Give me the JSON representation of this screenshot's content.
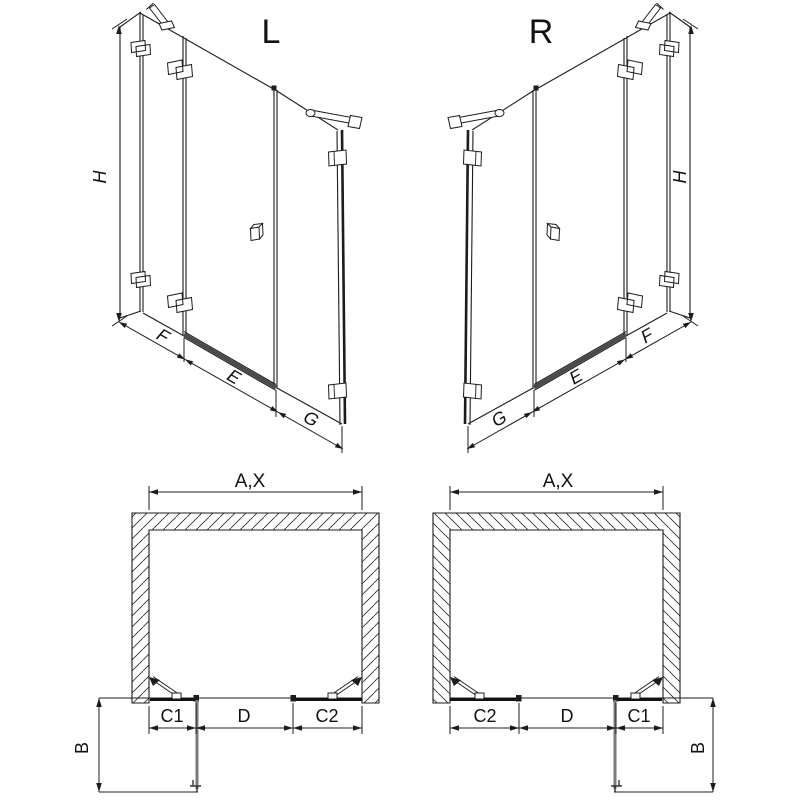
{
  "views": {
    "iso_left": {
      "label": "L",
      "height_dim": "H",
      "bottom_dims": [
        "F",
        "E",
        "G"
      ]
    },
    "iso_right": {
      "label": "R",
      "height_dim": "H",
      "bottom_dims": [
        "G",
        "E",
        "F"
      ]
    },
    "plan_left": {
      "width_dim": "A,X",
      "front_dims": [
        "C1",
        "D",
        "C2"
      ],
      "depth_dim": "B"
    },
    "plan_right": {
      "width_dim": "A,X",
      "front_dims": [
        "C2",
        "D",
        "C1"
      ],
      "depth_dim": "B"
    }
  },
  "colors": {
    "line": "#1c1c1c",
    "door_swing": "#7a7a7a",
    "rail": "#4a4a4a",
    "background": "#ffffff"
  }
}
